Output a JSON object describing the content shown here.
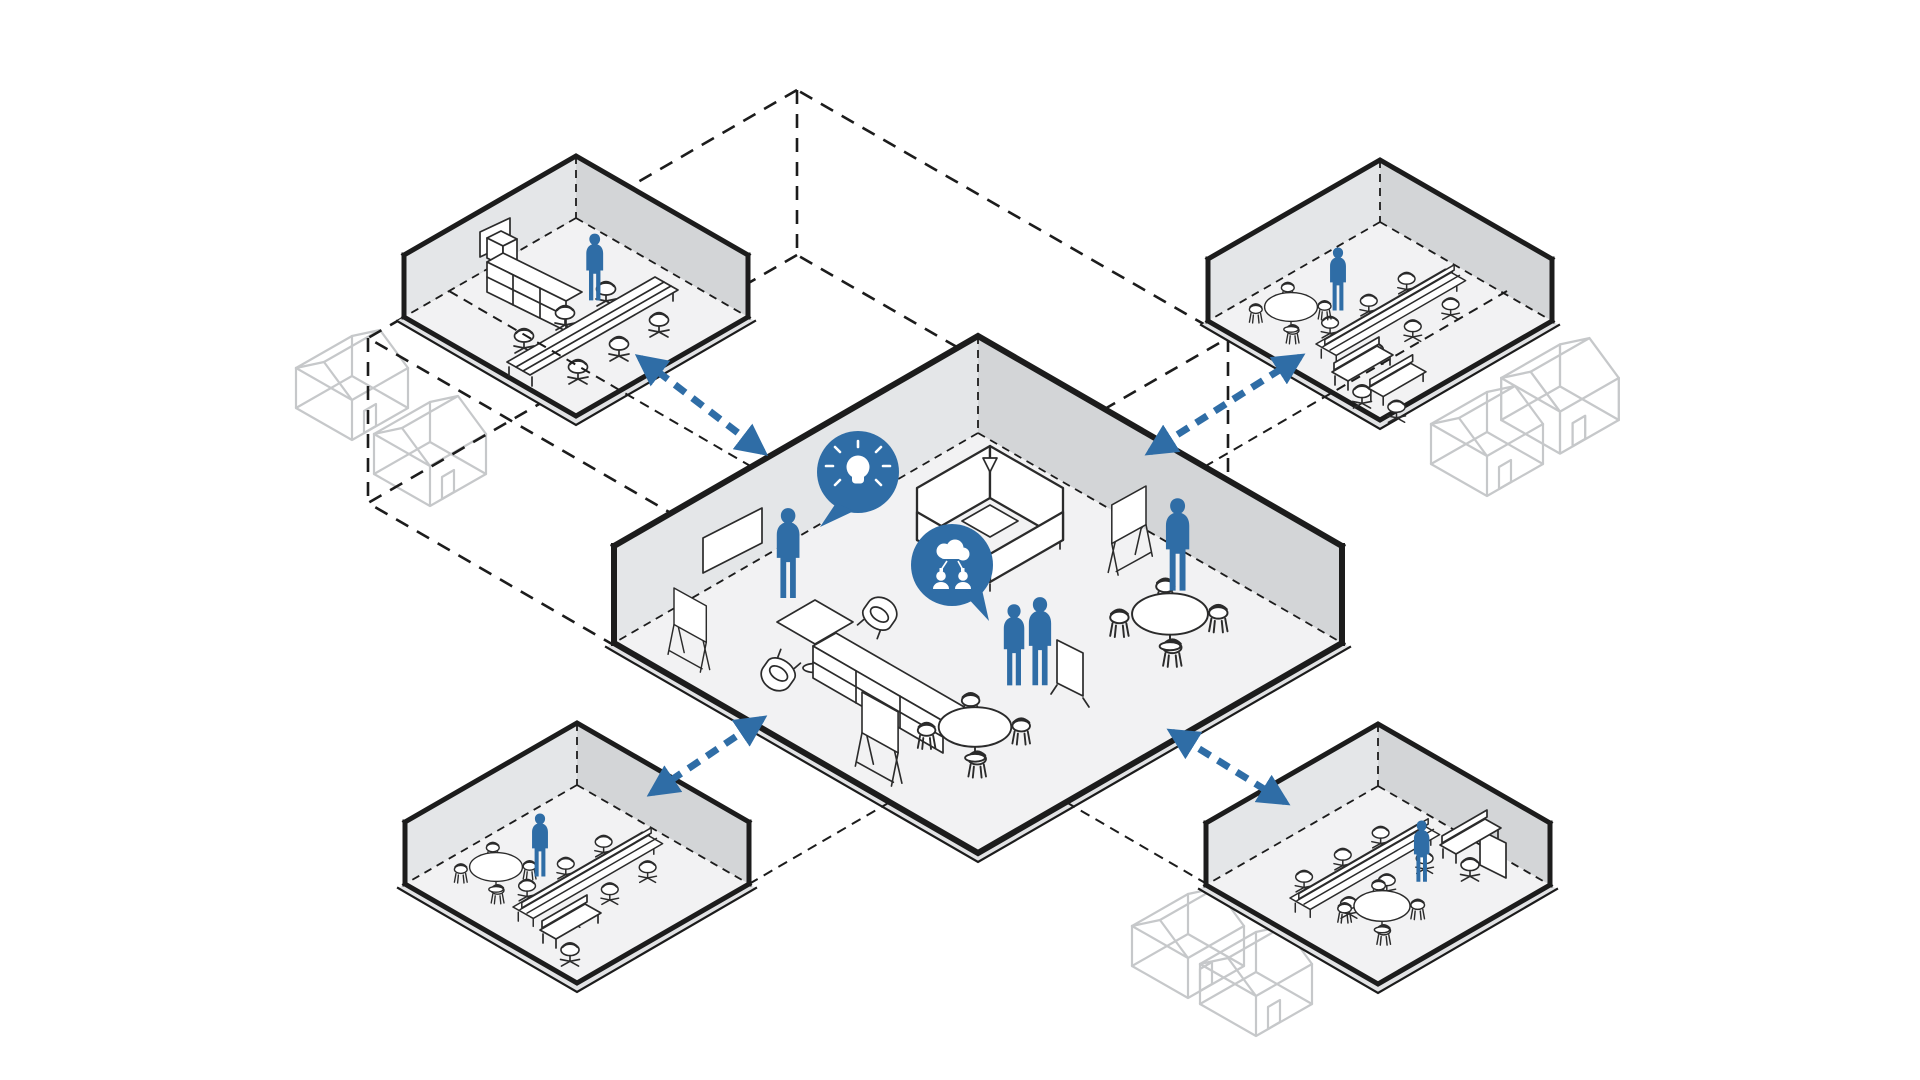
{
  "page": {
    "background": "#ffffff",
    "kind": "isometric hub-and-spoke workplace diagram"
  },
  "colors": {
    "bg": "#ffffff",
    "ink": "#1c1c1c",
    "fs": "#2b2b2b",
    "blue": "#2f6da6",
    "floor": "#f2f2f3",
    "wallL": "#e4e6e8",
    "wallR": "#d3d5d7",
    "band": "#e2e3e5",
    "house": "#c6c8ca"
  },
  "central_room": {
    "role": "central collaboration hub",
    "people": [
      "standing-person",
      "standing-pair",
      "standing-person"
    ],
    "speech_bubbles": [
      {
        "icon": "lightbulb-idea-icon"
      },
      {
        "icon": "team-network-cloud-icon"
      }
    ],
    "furniture": [
      "wall-whiteboard",
      "a-frame-easel",
      "coffee-table",
      "lounge-chairs",
      "acoustic-booth-pod",
      "open-shelving",
      "mobile-easel",
      "round-tables",
      "cafe-chairs",
      "privacy-screen"
    ]
  },
  "satellite_rooms": [
    {
      "position": "top-left",
      "people": 1,
      "furniture": [
        "wall-whiteboard",
        "storage-cubbies",
        "long-conference-table",
        "task-chairs"
      ]
    },
    {
      "position": "top-right",
      "people": 1,
      "furniture": [
        "bench-desks",
        "task-chairs",
        "round-table",
        "workstation-desks"
      ]
    },
    {
      "position": "bottom-left",
      "people": 1,
      "furniture": [
        "bench-desks",
        "task-chairs",
        "round-table",
        "workstation-desks"
      ]
    },
    {
      "position": "bottom-right",
      "people": 1,
      "furniture": [
        "bench-desks",
        "task-chairs",
        "round-table",
        "workstation-cubicle"
      ]
    }
  ],
  "connections": [
    {
      "from": "central",
      "to": "top-left",
      "style": "dashed",
      "bidirectional": true
    },
    {
      "from": "central",
      "to": "top-right",
      "style": "dashed",
      "bidirectional": true
    },
    {
      "from": "central",
      "to": "bottom-left",
      "style": "dashed",
      "bidirectional": true
    },
    {
      "from": "central",
      "to": "bottom-right",
      "style": "dashed",
      "bidirectional": true
    }
  ],
  "context_houses": {
    "count": 8,
    "style": "light-gray wireframe house",
    "placement": "pairs beside each satellite room"
  },
  "envelope": {
    "style": "large dashed isometric wireframe box linking all spaces"
  }
}
